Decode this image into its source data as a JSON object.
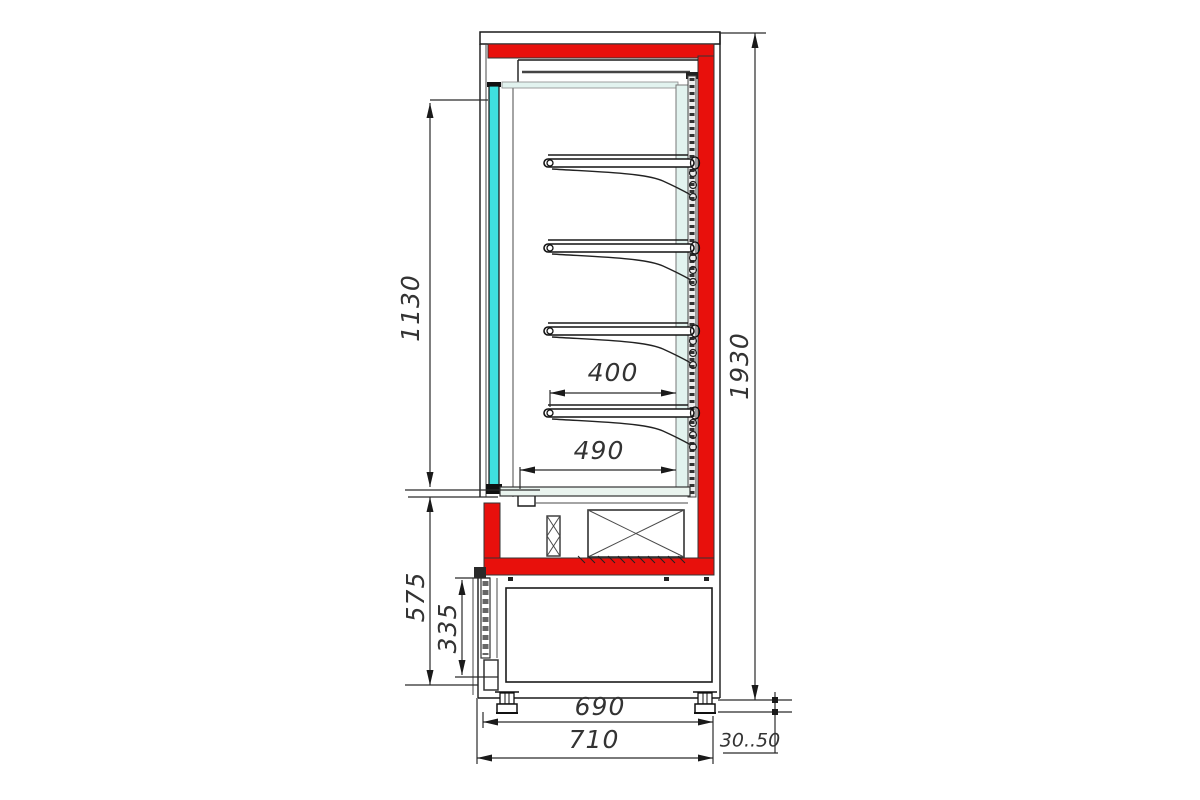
{
  "meta": {
    "drawing_type": "side-view-technical-drawing",
    "subject": "refrigerated-display-case"
  },
  "colors": {
    "red": "#e8100c",
    "glass": "#3fe0df",
    "panel": "#e2f3ef",
    "deck": "#eaf4ef",
    "strip": "#ededed",
    "dim_text": "#333333"
  },
  "dimensions": {
    "glass_door_height": "1130",
    "overall_height": "1930",
    "shelf_depth": "400",
    "deck_depth": "490",
    "lower_section_height": "575",
    "grille_height": "335",
    "base_width": "690",
    "overall_depth": "710",
    "leg_adjust_range": "30..50"
  }
}
